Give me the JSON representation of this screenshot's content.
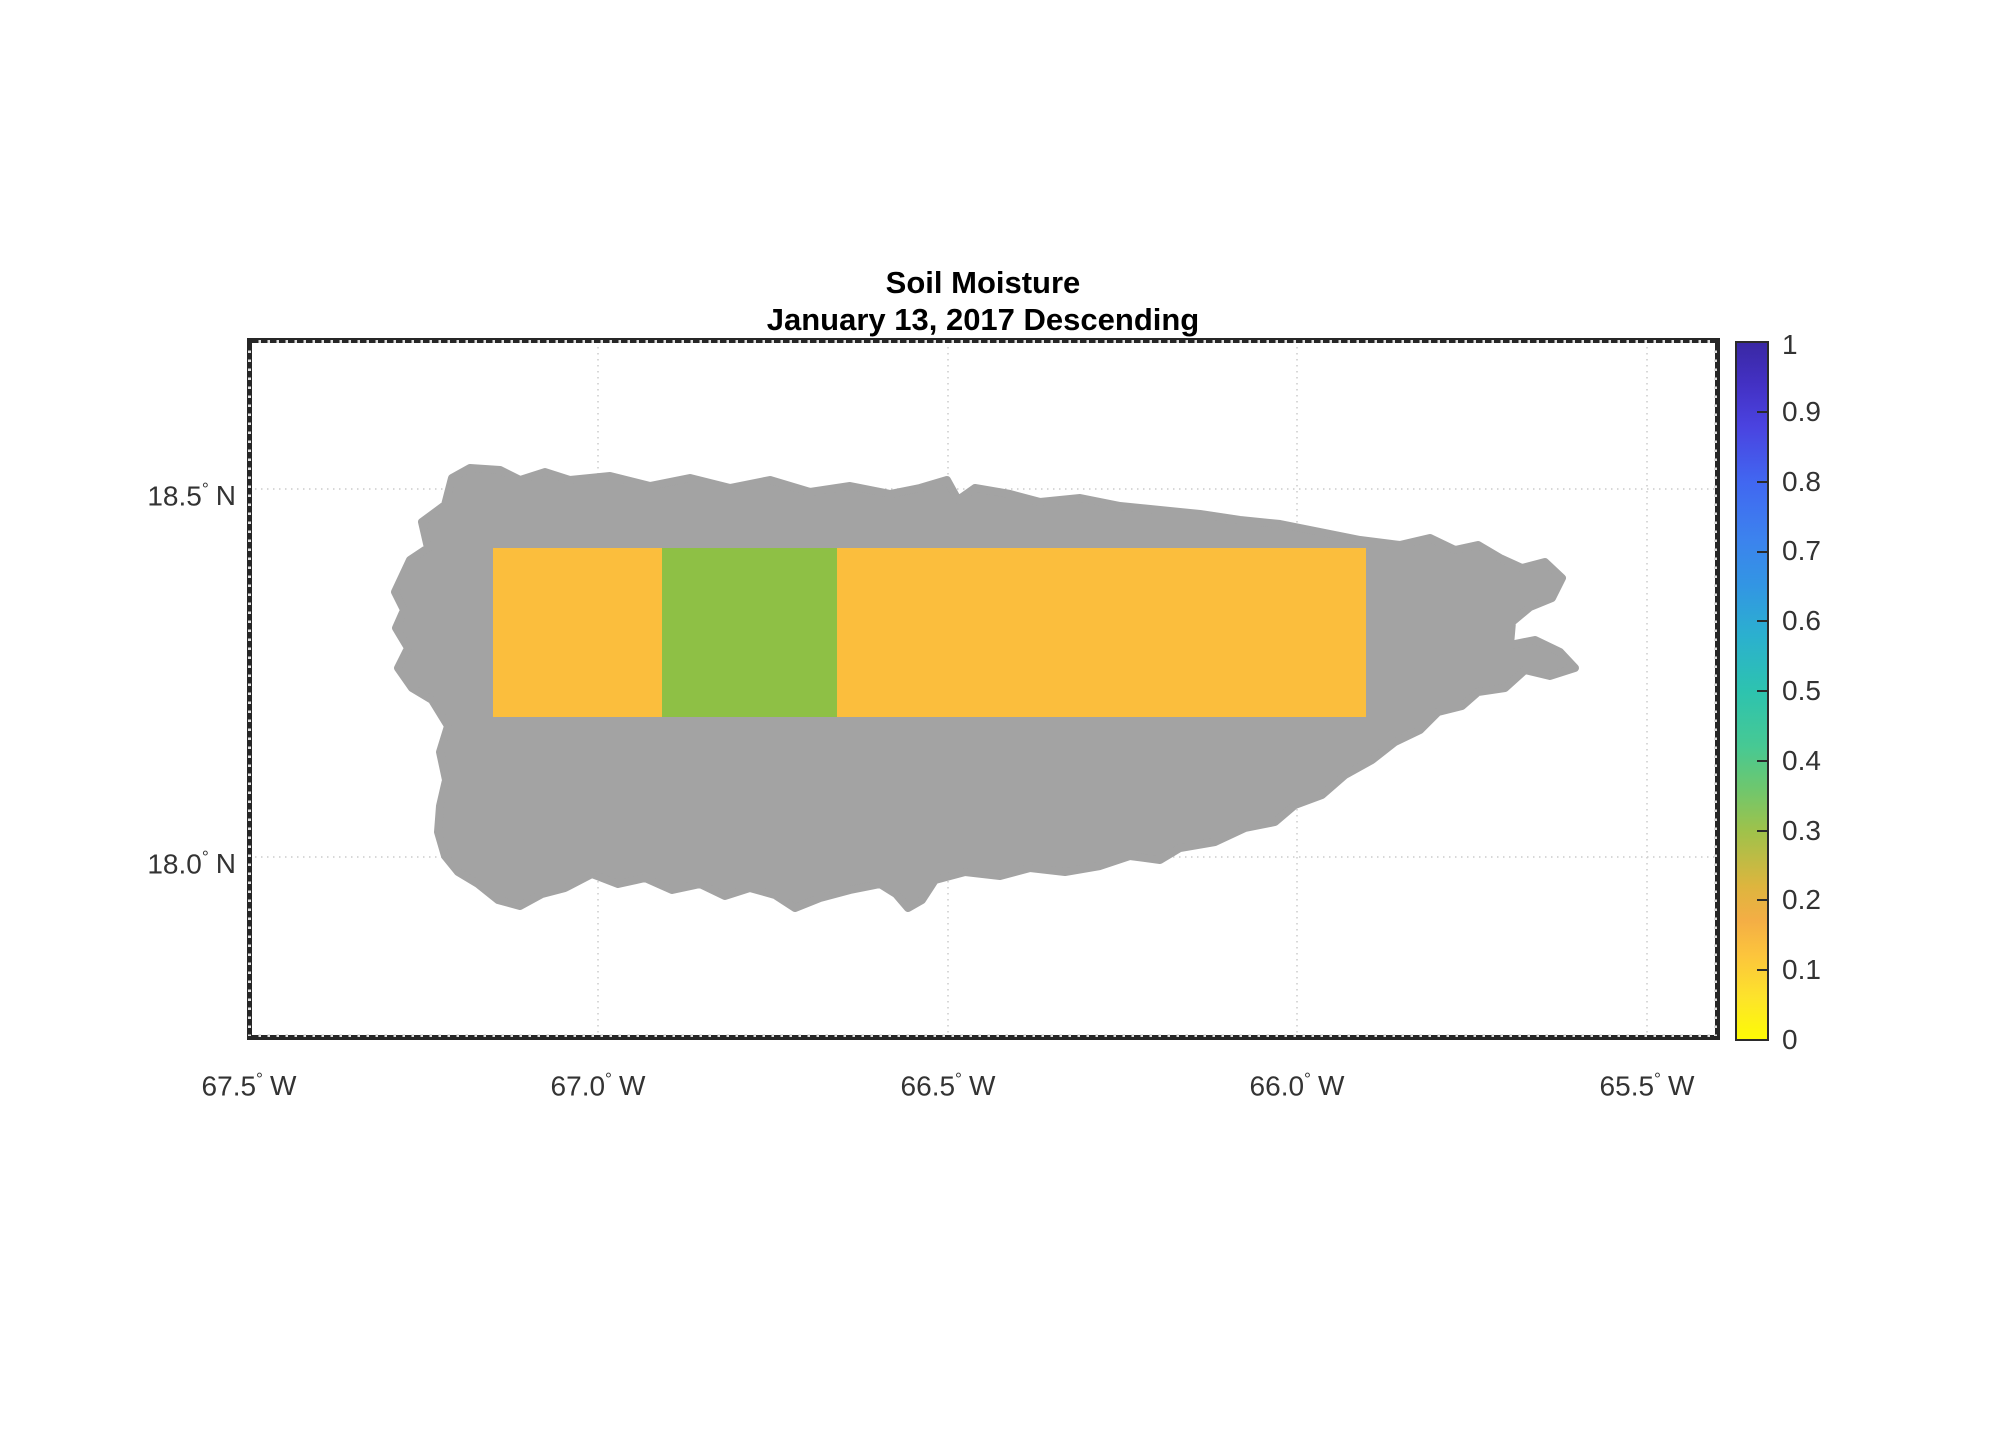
{
  "title": {
    "line1": "Soil Moisture",
    "line2": "January 13, 2017 Descending"
  },
  "axes": {
    "deg_symbol": "°",
    "y_ticks": [
      {
        "value": "18.5",
        "hemi": "N"
      },
      {
        "value": "18.0",
        "hemi": "N"
      }
    ],
    "x_ticks": [
      {
        "value": "67.5",
        "hemi": "W"
      },
      {
        "value": "67.0",
        "hemi": "W"
      },
      {
        "value": "66.5",
        "hemi": "W"
      },
      {
        "value": "66.0",
        "hemi": "W"
      },
      {
        "value": "65.5",
        "hemi": "W"
      }
    ]
  },
  "colorbar": {
    "tick_labels": [
      "1",
      "0.9",
      "0.8",
      "0.7",
      "0.6",
      "0.5",
      "0.4",
      "0.3",
      "0.2",
      "0.1",
      "0"
    ],
    "gradient": [
      {
        "offset": 0.0,
        "color": "#fdfb05"
      },
      {
        "offset": 0.06,
        "color": "#fde32b"
      },
      {
        "offset": 0.12,
        "color": "#fcc53c"
      },
      {
        "offset": 0.17,
        "color": "#f4ae45"
      },
      {
        "offset": 0.22,
        "color": "#ddb53e"
      },
      {
        "offset": 0.3,
        "color": "#9ec24b"
      },
      {
        "offset": 0.36,
        "color": "#6ec76e"
      },
      {
        "offset": 0.42,
        "color": "#47c993"
      },
      {
        "offset": 0.5,
        "color": "#2dc3af"
      },
      {
        "offset": 0.58,
        "color": "#2bb0cf"
      },
      {
        "offset": 0.65,
        "color": "#3296e3"
      },
      {
        "offset": 0.72,
        "color": "#3c82ee"
      },
      {
        "offset": 0.8,
        "color": "#4167f1"
      },
      {
        "offset": 0.88,
        "color": "#4a43e0"
      },
      {
        "offset": 0.94,
        "color": "#4331c4"
      },
      {
        "offset": 1.0,
        "color": "#3a28a4"
      }
    ]
  },
  "colors": {
    "land": "#a3a3a3",
    "cell_low": "#fbbe3d",
    "cell_mid": "#8ec045",
    "gridline": "#cccccc",
    "frame": "#262626"
  },
  "chart_data": {
    "type": "heatmap",
    "title": "Soil Moisture",
    "subtitle": "January 13, 2017 Descending",
    "x_ticks": [
      "67.5° W",
      "67.0° W",
      "66.5° W",
      "66.0° W",
      "65.5° W"
    ],
    "y_ticks": [
      "18.5° N",
      "18.0° N"
    ],
    "colorbar": {
      "range": [
        0,
        1
      ],
      "tick_step": 0.1,
      "orientation": "vertical",
      "position": "right"
    },
    "grid": "dotted, 0.5-degree graticule",
    "basemap": "Puerto Rico landmass shown in gray (no-data)",
    "cells": [
      {
        "region": "west cell",
        "approx_lon_w": [
          67.15,
          66.91
        ],
        "approx_lat_n": [
          18.19,
          18.42
        ],
        "soil_moisture_estimate": 0.13,
        "color": "#fbbe3d"
      },
      {
        "region": "central cell",
        "approx_lon_w": [
          66.91,
          66.66
        ],
        "approx_lat_n": [
          18.19,
          18.42
        ],
        "soil_moisture_estimate": 0.3,
        "color": "#8ec045"
      },
      {
        "region": "east cell",
        "approx_lon_w": [
          66.66,
          65.9
        ],
        "approx_lat_n": [
          18.19,
          18.42
        ],
        "soil_moisture_estimate": 0.13,
        "color": "#fbbe3d"
      }
    ]
  }
}
